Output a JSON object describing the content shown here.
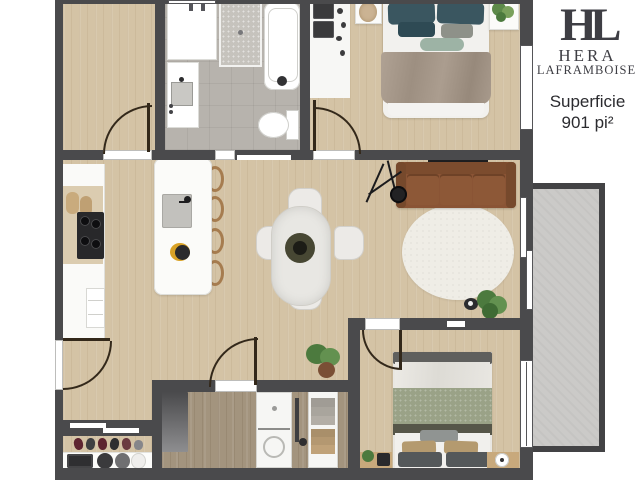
{
  "brand": {
    "monogram": "HL",
    "line1": "HERA",
    "line2": "LAFRAMBOISE"
  },
  "area": {
    "label": "Superficie",
    "value": "901 pi²"
  },
  "palette": {
    "wall": "#4a4a4c",
    "wood_floor": "#d4c3a5",
    "tile_floor": "#b7b3ad",
    "balcony_concrete": "#cbcac8",
    "sofa_leather": "#8a5435",
    "bed1_pillows_teal": "#3a5660",
    "bed1_duvet_taupe": "#a89a8c",
    "bed2_duvet_sage": "#9aa287",
    "rug_cream": "#efede6",
    "plant_green": "#4c7a3e",
    "logo_charcoal": "#3e3e44"
  }
}
